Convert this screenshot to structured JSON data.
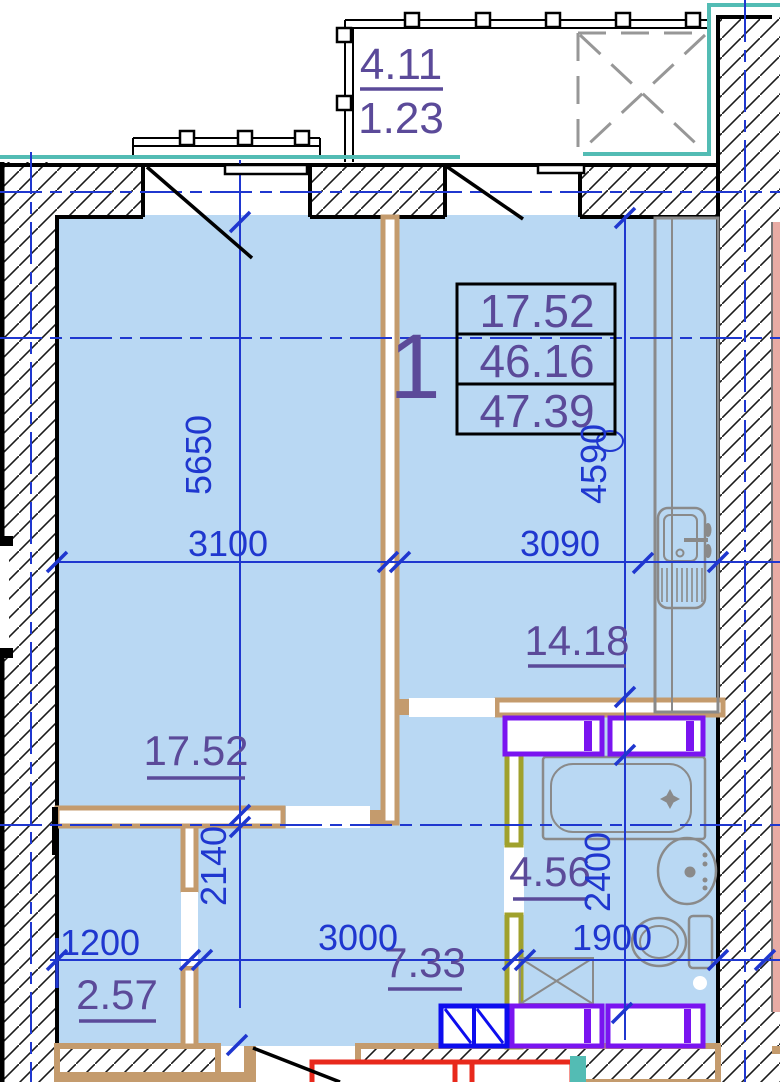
{
  "labels": {
    "apartment_number": "1",
    "info_table": {
      "row1": "17.52",
      "row2": "46.16",
      "row3": "47.39"
    },
    "balcony_top": "4.11",
    "balcony_bottom": "1.23",
    "kitchen": "14.18",
    "living_room": "17.52",
    "bathroom": "4.56",
    "hallway": "7.33",
    "closet": "2.57"
  },
  "dimensions": {
    "living_width": "3100",
    "kitchen_width": "3090",
    "living_depth": "5650",
    "kitchen_depth": "4590",
    "hallway_depth": "2140",
    "bathroom_depth": "2400",
    "closet_width": "1200",
    "hallway_width": "3000",
    "bathroom_width": "1900"
  },
  "colors": {
    "room_fill": "#b9d8f3",
    "dimension_blue": "#1f37cf",
    "area_purple": "#5b4a99",
    "wall_tan": "#c49b6d",
    "hatch_black": "#1a1a1a",
    "teal": "#53bcb4",
    "vent_violet": "#7a14f0",
    "vent_blue": "#0d0dee",
    "door_olive": "#a0a12c",
    "fixture_gray": "#8a8a8a",
    "neighbor_pink": "#e8aba4",
    "stair_red": "#e8291c"
  }
}
